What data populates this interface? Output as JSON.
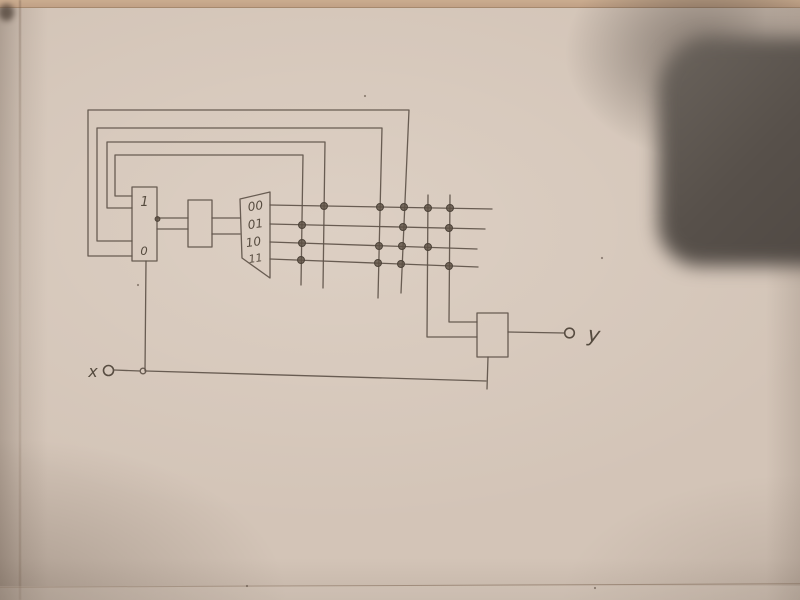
{
  "labels": {
    "register_top": "1",
    "register_bottom": "0",
    "decoder_rows": [
      "00",
      "01",
      "10",
      "11"
    ],
    "input": "x",
    "output": "y"
  },
  "colors": {
    "paper": "#d3c4b7",
    "ink": "#5e5349",
    "shadow_object": "#55504a",
    "junction_dot": "#5d5044"
  },
  "matrix": {
    "row_labels": [
      "00",
      "01",
      "10",
      "11"
    ],
    "dots_per_row": [
      5,
      3,
      4,
      4
    ]
  },
  "geometry": {
    "junction_dots": [
      [
        324,
        206
      ],
      [
        380,
        207
      ],
      [
        404,
        207
      ],
      [
        428,
        208
      ],
      [
        450,
        208
      ],
      [
        302,
        225
      ],
      [
        403,
        227
      ],
      [
        449,
        228
      ],
      [
        302,
        243
      ],
      [
        379,
        246
      ],
      [
        402,
        246
      ],
      [
        428,
        247
      ],
      [
        301,
        260
      ],
      [
        378,
        263
      ],
      [
        401,
        264
      ],
      [
        449,
        266
      ],
      [
        157.5,
        219
      ]
    ],
    "paper_specks": [
      [
        138,
        285
      ],
      [
        247,
        586
      ],
      [
        595,
        588
      ],
      [
        602,
        258
      ],
      [
        365,
        96
      ]
    ]
  }
}
